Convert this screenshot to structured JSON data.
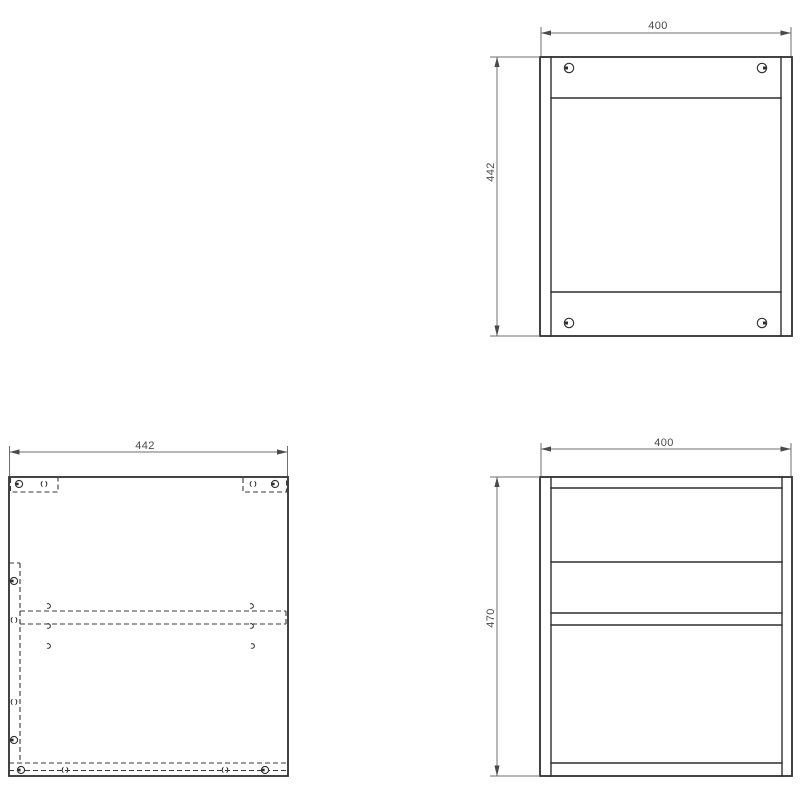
{
  "drawing": {
    "views": {
      "back": {
        "width_label": "400",
        "height_label": "442"
      },
      "bottom": {
        "width_label": "442"
      },
      "side": {
        "width_label": "400",
        "height_label": "470"
      }
    },
    "colors": {
      "background": "#ffffff",
      "outline": "#2f2f2f",
      "hidden_line": "#3a3a3a",
      "dimension": "#6f6f6f",
      "label_text": "#4a4a4a"
    },
    "icons": {
      "cam_lock": "cam-lock-icon",
      "dowel": "dowel-icon",
      "screw": "screw-icon"
    }
  }
}
